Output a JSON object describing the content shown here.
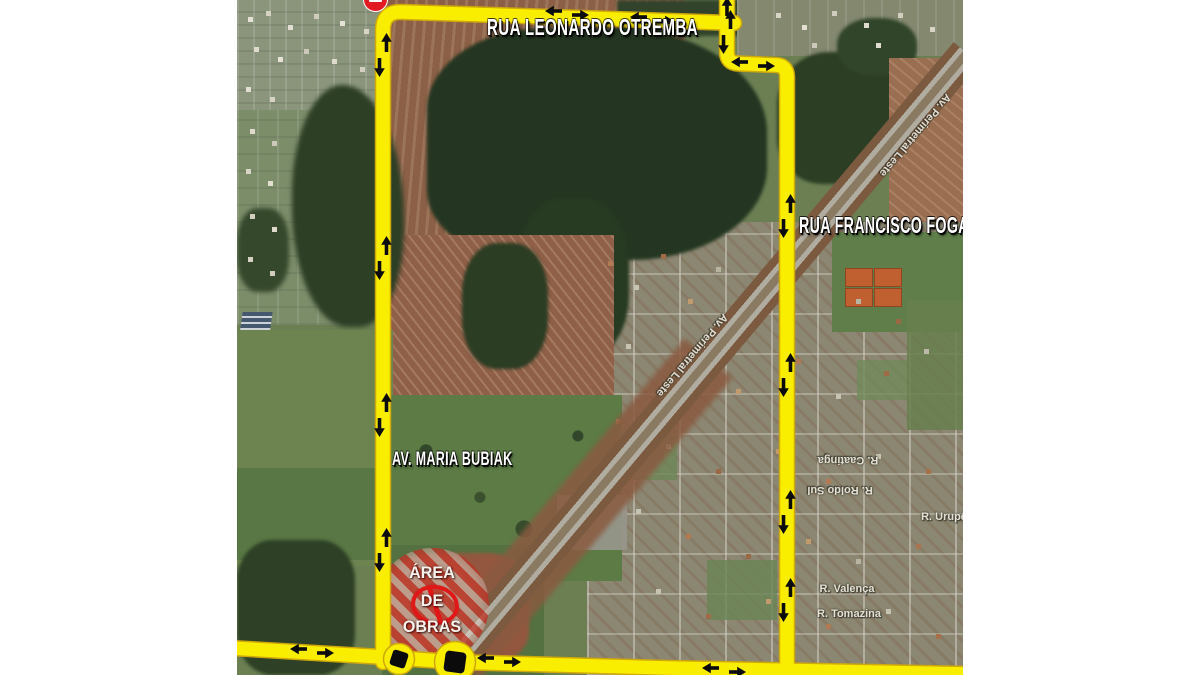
{
  "map": {
    "road_labels": {
      "top": "RUA LEONARDO OTREMBA",
      "right": "RUA FRANCISCO FOGAÇA",
      "left": "AV. MARIA BUBIAK"
    },
    "construction_zone": {
      "line1": "ÁREA",
      "line2": "DE",
      "line3": "OBRAS"
    },
    "street_labels": {
      "perimetral_mid": "Av. Perimetral Leste",
      "perimetral_top": "Av. Perimetral Leste",
      "caatinga": "R. Caatinga",
      "roldo_sul": "R. Roldo Sul",
      "urupe": "R. Urupê",
      "valenca": "R. Valença",
      "tomazina": "R. Tomazina"
    },
    "colors": {
      "route_yellow": "#F9ED00",
      "arrow_black": "#0B0B0B",
      "hazard_red": "#E01818"
    }
  }
}
